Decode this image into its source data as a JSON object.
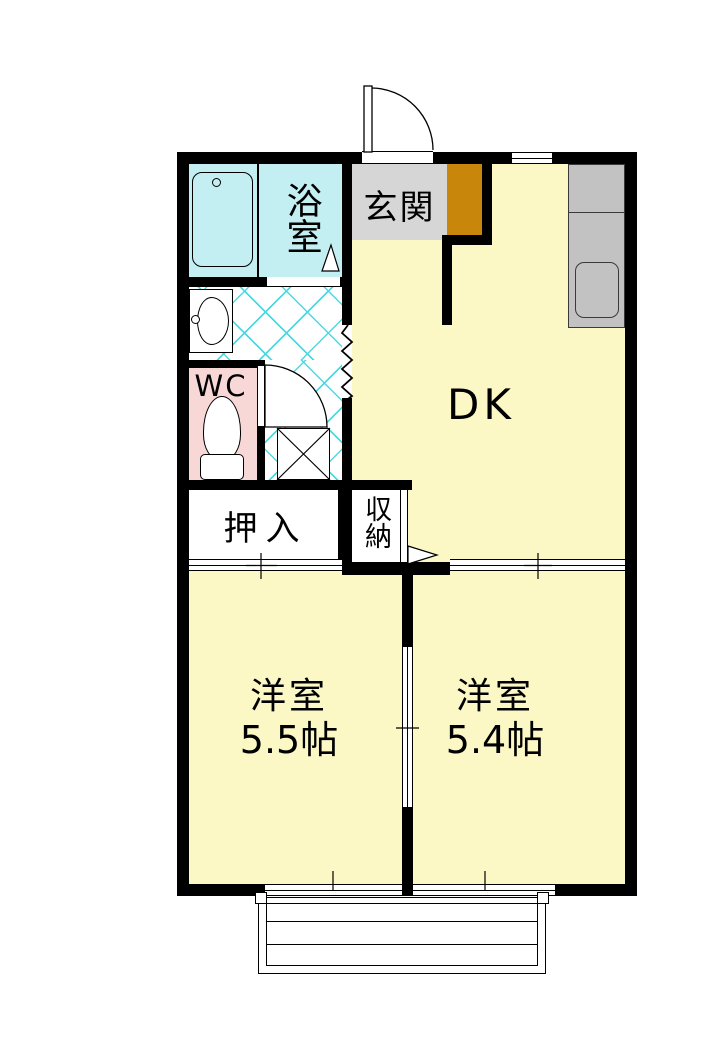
{
  "plan": {
    "kind": "apartment-floor-plan",
    "rooms": {
      "genkan": {
        "label": "玄関",
        "color": "#D6D6D6"
      },
      "bathroom": {
        "label": "浴室",
        "color": "#C4EFF2"
      },
      "dk": {
        "label": "DK",
        "color": "#FBF8C6"
      },
      "wc": {
        "label": "WC",
        "color": "#F8D7D7"
      },
      "oshiire": {
        "label": "押入",
        "color": "#FFFFFF"
      },
      "shuunou": {
        "label": "収納",
        "color": "#FFFFFF"
      },
      "bedroom_left": {
        "label": "洋室",
        "size": "5.5帖",
        "color": "#FBF8C6"
      },
      "bedroom_right": {
        "label": "洋室",
        "size": "5.4帖",
        "color": "#FBF8C6"
      }
    },
    "colors": {
      "wall": "#000000",
      "shoe_cabinet": "#C8860B",
      "kitchen_counter": "#C2C2C2",
      "tile_line": "#4ED9E2",
      "hallway_floor": "#FFFFFF",
      "fixture_fill": "#FFFFFF"
    },
    "icons": [
      "bathtub-icon",
      "bath-drain-icon",
      "washbasin-icon",
      "toilet-icon",
      "washing-machine-x-icon",
      "kitchen-sink-icon",
      "entrance-door-arc-icon",
      "wc-door-arc-icon",
      "storage-door-arrow-icon",
      "bath-door-triangle-icon",
      "step-zigzag-icon",
      "balcony-railing-icon",
      "sliding-door-tick-icon"
    ]
  }
}
